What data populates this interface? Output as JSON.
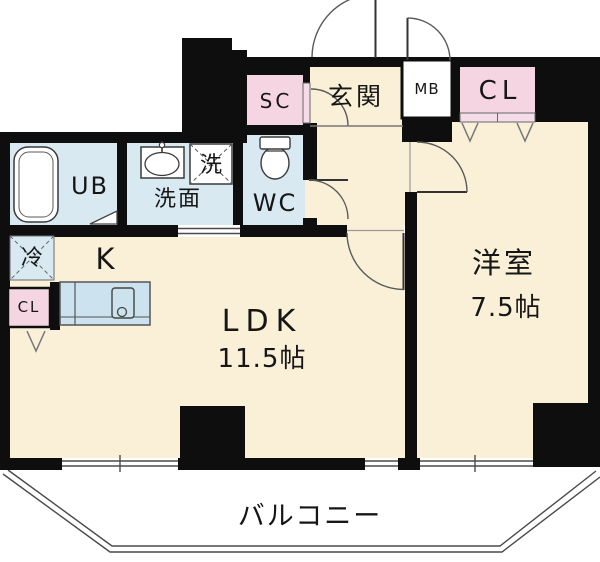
{
  "title": "1LDK floor plan",
  "colors": {
    "floor_cream": "#faf0d8",
    "sanitary_blue": "#d8e9f2",
    "counter_blue": "#cce2ee",
    "closet_pink": "#f5d5e1",
    "wall_black": "#0e0e0e"
  },
  "rooms": {
    "ldk": {
      "label": "LDK",
      "size": "11.5帖"
    },
    "kitchen": {
      "label": "K"
    },
    "western_room": {
      "label": "洋室",
      "size": "7.5帖"
    },
    "entrance": {
      "label": "玄関"
    },
    "washroom": {
      "label": "洗面"
    },
    "bath": {
      "label": "UB"
    },
    "toilet": {
      "label": "WC"
    },
    "balcony": {
      "label": "バルコニー"
    }
  },
  "storage": {
    "shoe_closet": {
      "label": "SC"
    },
    "meter_box": {
      "label": "MB"
    },
    "bedroom_closet": {
      "label": "CL"
    },
    "kitchen_closet": {
      "label": "CL"
    }
  },
  "fixtures": {
    "washing_machine": {
      "label": "洗"
    },
    "refrigerator": {
      "label": "冷"
    }
  }
}
